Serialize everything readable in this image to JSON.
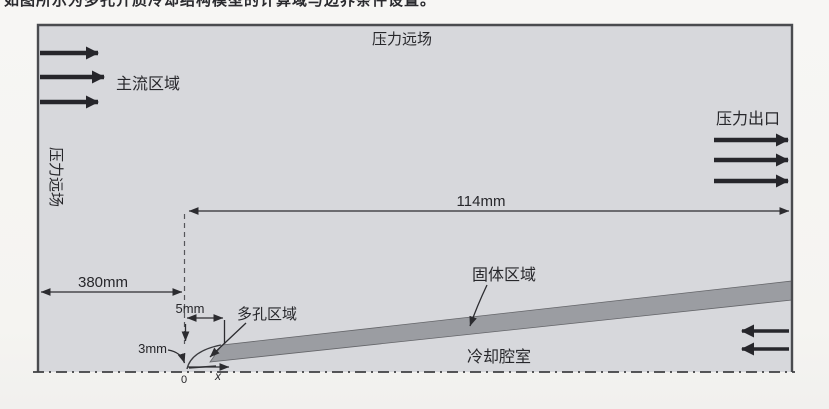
{
  "caption_fragment": "如图所示为多孔介质冷却结构模型的计算域与边界条件设置。",
  "diagram": {
    "boundaries": {
      "top_far_field": "压力远场",
      "left_far_field": "压力远场",
      "outlet": "压力出口"
    },
    "regions": {
      "main_flow": "主流区域",
      "porous": "多孔区域",
      "solid": "固体区域",
      "cooling_chamber": "冷却腔室"
    },
    "dimensions": {
      "downstream_length": "114mm",
      "upstream_length": "380mm",
      "porous_width": "5mm",
      "porous_height": "3mm"
    },
    "axes": {
      "origin_label": "0",
      "x_label": "x"
    },
    "colors": {
      "domain_fill": "#d7d8dc",
      "solid_fill": "#9b9da2",
      "ink": "#27272b",
      "border": "#4a4b4f"
    }
  }
}
